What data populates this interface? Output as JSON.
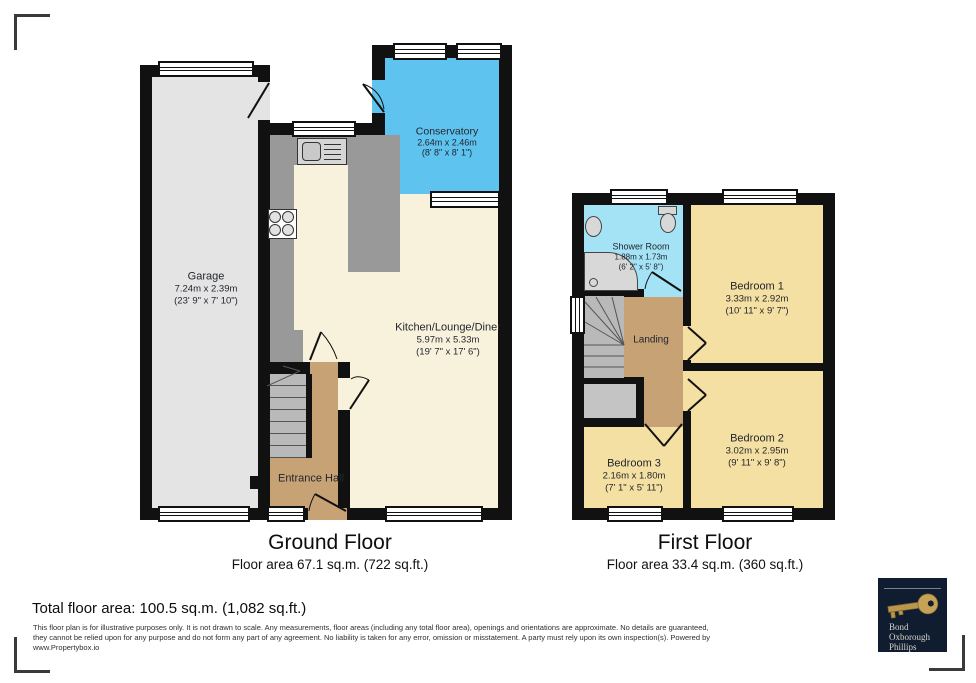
{
  "ground_floor": {
    "title": "Ground Floor",
    "area_label": "Floor area 67.1 sq.m. (722 sq.ft.)",
    "garage": {
      "name": "Garage",
      "metric": "7.24m x 2.39m",
      "imperial": "(23' 9\" x 7' 10\")"
    },
    "conservatory": {
      "name": "Conservatory",
      "metric": "2.64m x 2.46m",
      "imperial": "(8' 8\" x 8' 1\")"
    },
    "kitchen_lounge_diner": {
      "name": "Kitchen/Lounge/Diner",
      "metric": "5.97m x 5.33m",
      "imperial": "(19' 7\" x 17' 6\")"
    },
    "entrance_hall": {
      "name": "Entrance Hall"
    }
  },
  "first_floor": {
    "title": "First Floor",
    "area_label": "Floor area 33.4 sq.m. (360 sq.ft.)",
    "shower_room": {
      "name": "Shower Room",
      "metric": "1.88m x 1.73m",
      "imperial": "(6' 2\" x 5' 8\")"
    },
    "bedroom_1": {
      "name": "Bedroom 1",
      "metric": "3.33m x 2.92m",
      "imperial": "(10' 11\" x 9' 7\")"
    },
    "bedroom_2": {
      "name": "Bedroom 2",
      "metric": "3.02m x 2.95m",
      "imperial": "(9' 11\" x 9' 8\")"
    },
    "bedroom_3": {
      "name": "Bedroom 3",
      "metric": "2.16m x 1.80m",
      "imperial": "(7' 1\" x 5' 11\")"
    },
    "landing": {
      "name": "Landing"
    }
  },
  "summary": {
    "total_area": "Total floor area: 100.5 sq.m. (1,082 sq.ft.)"
  },
  "disclaimer": {
    "line1": "This floor plan is for illustrative purposes only. It is not drawn to scale. Any measurements, floor areas (including any total floor area), openings and orientations are approximate. No details are guaranteed,",
    "line2": "they cannot be relied upon for any purpose and do not form any part of any agreement. No liability is taken for any error, omission or misstatement. A party must rely upon its own inspection(s). Powered by",
    "line3": "www.Propertybox.io"
  },
  "logo": {
    "name_line1": "Bond",
    "name_line2": "Oxborough",
    "name_line3": "Phillips"
  },
  "colors": {
    "wall": "#111111",
    "garage": "#e4e4e4",
    "living": "#f8f2dc",
    "bedroom": "#f5e0a3",
    "conservatory": "#5fc3ef",
    "shower": "#a4e3f5",
    "hall": "#c7a274",
    "counter": "#999999",
    "stairs": "#b9b9b9",
    "logo_bg": "#101d31",
    "key_gold": "#b9974b"
  }
}
